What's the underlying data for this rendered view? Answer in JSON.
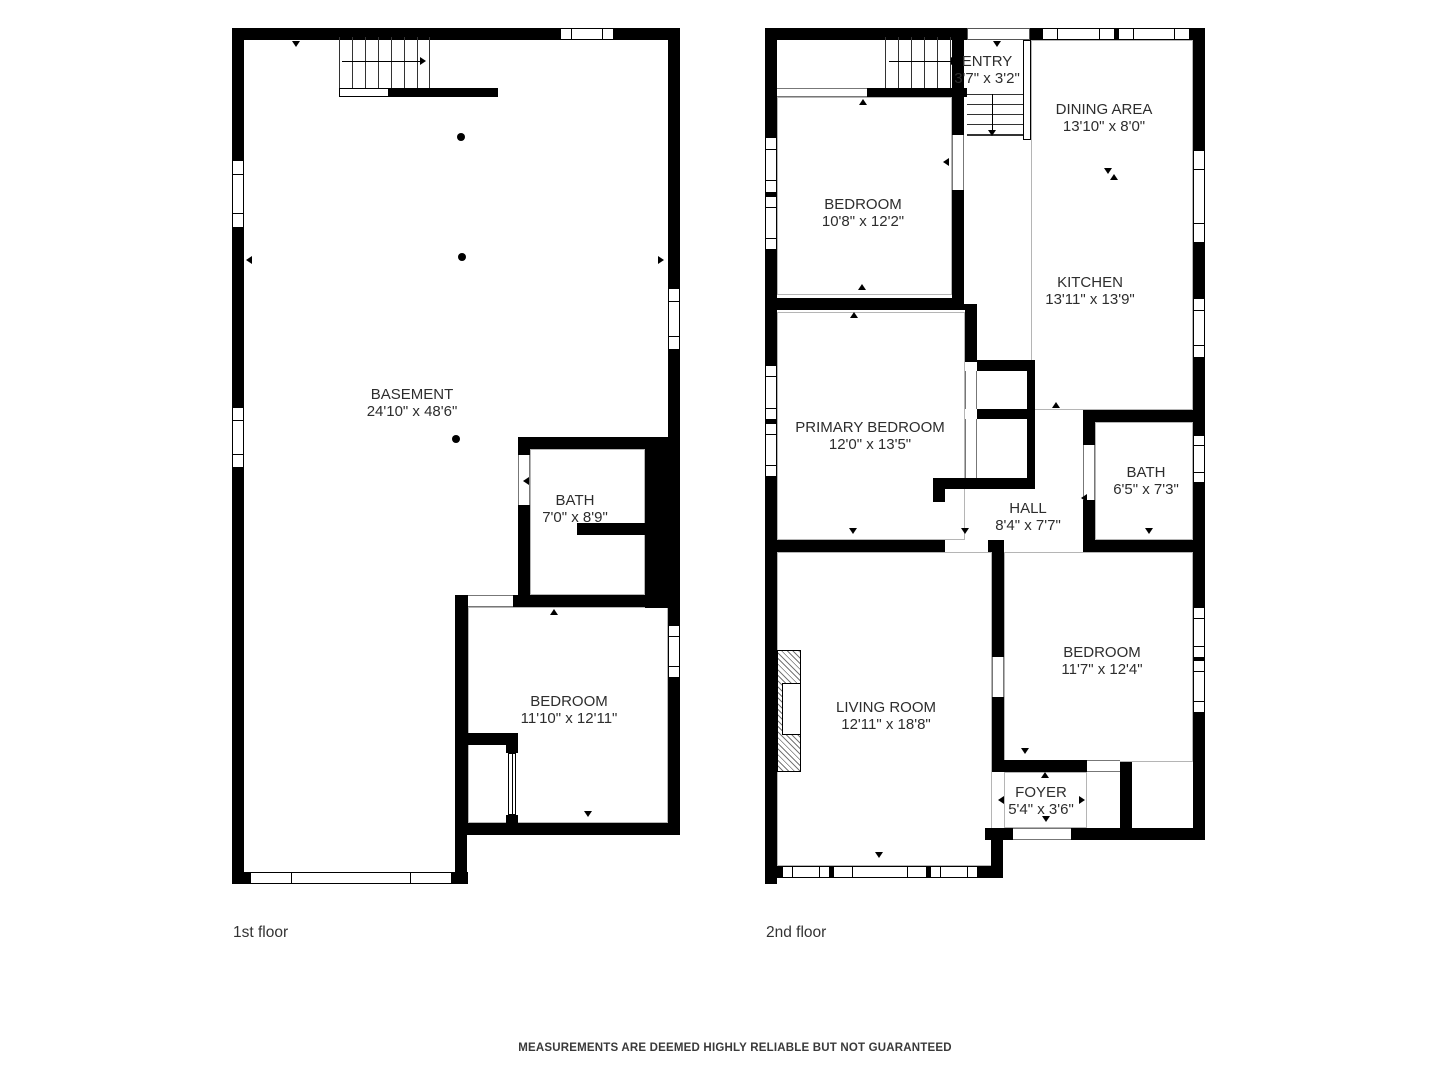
{
  "page": {
    "disclaimer": "MEASUREMENTS ARE DEEMED HIGHLY RELIABLE BUT NOT GUARANTEED"
  },
  "colors": {
    "wall": "#000000",
    "label_text": "#2d2d2d",
    "room_outline": "#b5b5b5",
    "background": "#ffffff"
  },
  "floors": [
    {
      "label": "1st floor",
      "rooms": [
        {
          "name": "BASEMENT",
          "dims": "24'10\" x 48'6\""
        },
        {
          "name": "BATH",
          "dims": "7'0\" x 8'9\""
        },
        {
          "name": "BEDROOM",
          "dims": "11'10\" x 12'11\""
        }
      ]
    },
    {
      "label": "2nd floor",
      "rooms": [
        {
          "name": "ENTRY",
          "dims": "3'7\" x 3'2\""
        },
        {
          "name": "DINING AREA",
          "dims": "13'10\" x 8'0\""
        },
        {
          "name": "BEDROOM",
          "dims": "10'8\" x 12'2\""
        },
        {
          "name": "KITCHEN",
          "dims": "13'11\" x 13'9\""
        },
        {
          "name": "PRIMARY BEDROOM",
          "dims": "12'0\" x 13'5\""
        },
        {
          "name": "BATH",
          "dims": "6'5\" x 7'3\""
        },
        {
          "name": "HALL",
          "dims": "8'4\" x 7'7\""
        },
        {
          "name": "LIVING ROOM",
          "dims": "12'11\" x 18'8\""
        },
        {
          "name": "BEDROOM",
          "dims": "11'7\" x 12'4\""
        },
        {
          "name": "FOYER",
          "dims": "5'4\" x 3'6\""
        }
      ]
    }
  ]
}
